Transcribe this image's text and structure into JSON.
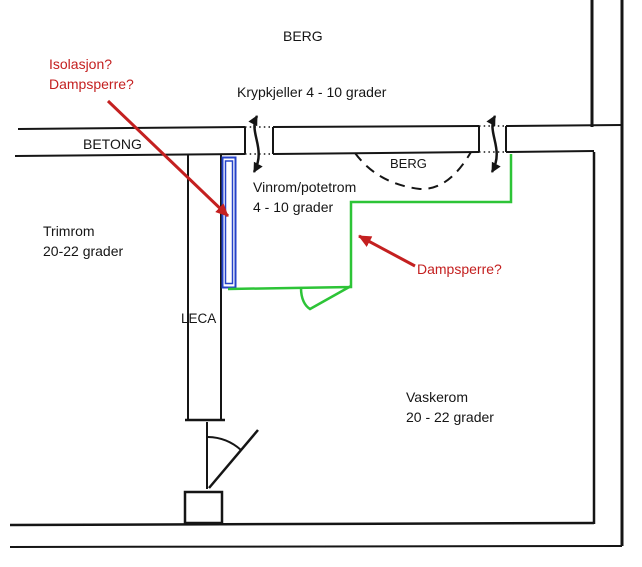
{
  "colors": {
    "line_black": "#151515",
    "red": "#C42020",
    "green": "#2DC437",
    "blue": "#2442C8",
    "background": "#FFFFFF"
  },
  "diagram": {
    "areas": {
      "berg_top": {
        "label": "BERG"
      },
      "krypkjeller": {
        "label": "Krypkjeller 4 - 10 grader"
      },
      "betong": {
        "label": "BETONG"
      },
      "berg_pocket": {
        "label": "BERG"
      },
      "vinrom": {
        "line1": "Vinrom/potetrom",
        "line2": "4 - 10 grader"
      },
      "trimrom": {
        "line1": "Trimrom",
        "line2": "20-22 grader"
      },
      "leca": {
        "label": "LECA"
      },
      "vaskerom": {
        "line1": "Vaskerom",
        "line2": "20 - 22 grader"
      }
    },
    "annotations": {
      "question_top": {
        "line1": "Isolasjon?",
        "line2": "Dampsperre?"
      },
      "question_right": {
        "label": "Dampsperre?"
      }
    }
  }
}
